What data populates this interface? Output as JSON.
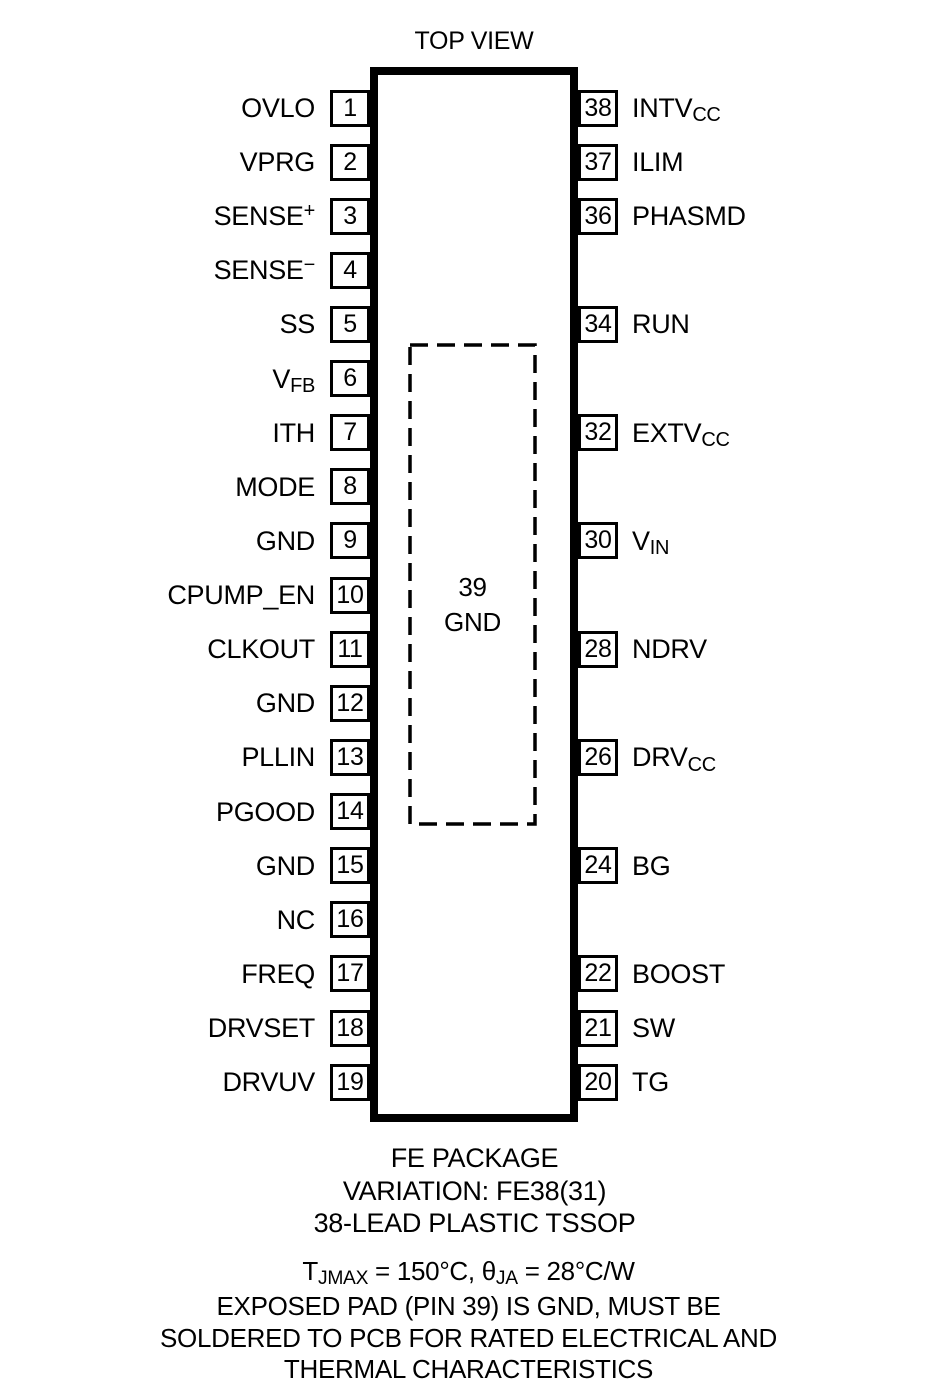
{
  "title": "TOP VIEW",
  "exposed_pad": {
    "number": "39",
    "label": "GND"
  },
  "left_pins": [
    {
      "num": "1",
      "label": [
        {
          "t": "OVLO"
        }
      ]
    },
    {
      "num": "2",
      "label": [
        {
          "t": "VPRG"
        }
      ]
    },
    {
      "num": "3",
      "label": [
        {
          "t": "SENSE"
        },
        {
          "t": "+",
          "style": "sup"
        }
      ]
    },
    {
      "num": "4",
      "label": [
        {
          "t": "SENSE"
        },
        {
          "t": "−",
          "style": "sup"
        }
      ]
    },
    {
      "num": "5",
      "label": [
        {
          "t": "SS"
        }
      ]
    },
    {
      "num": "6",
      "label": [
        {
          "t": "V"
        },
        {
          "t": "FB",
          "style": "sub"
        }
      ]
    },
    {
      "num": "7",
      "label": [
        {
          "t": "ITH"
        }
      ]
    },
    {
      "num": "8",
      "label": [
        {
          "t": "MODE"
        }
      ]
    },
    {
      "num": "9",
      "label": [
        {
          "t": "GND"
        }
      ]
    },
    {
      "num": "10",
      "label": [
        {
          "t": "CPUMP_EN"
        }
      ]
    },
    {
      "num": "11",
      "label": [
        {
          "t": "CLKOUT"
        }
      ]
    },
    {
      "num": "12",
      "label": [
        {
          "t": "GND"
        }
      ]
    },
    {
      "num": "13",
      "label": [
        {
          "t": "PLLIN"
        }
      ]
    },
    {
      "num": "14",
      "label": [
        {
          "t": "PGOOD"
        }
      ]
    },
    {
      "num": "15",
      "label": [
        {
          "t": "GND"
        }
      ]
    },
    {
      "num": "16",
      "label": [
        {
          "t": "NC"
        }
      ]
    },
    {
      "num": "17",
      "label": [
        {
          "t": "FREQ"
        }
      ]
    },
    {
      "num": "18",
      "label": [
        {
          "t": "DRVSET"
        }
      ]
    },
    {
      "num": "19",
      "label": [
        {
          "t": "DRVUV"
        }
      ]
    }
  ],
  "right_pins": [
    {
      "num": "38",
      "row": 1,
      "label": [
        {
          "t": "INTV"
        },
        {
          "t": "CC",
          "style": "sub"
        }
      ]
    },
    {
      "num": "37",
      "row": 2,
      "label": [
        {
          "t": "ILIM"
        }
      ]
    },
    {
      "num": "36",
      "row": 3,
      "label": [
        {
          "t": "PHASMD"
        }
      ]
    },
    {
      "num": "34",
      "row": 5,
      "label": [
        {
          "t": "RUN"
        }
      ]
    },
    {
      "num": "32",
      "row": 7,
      "label": [
        {
          "t": "EXTV"
        },
        {
          "t": "CC",
          "style": "sub"
        }
      ]
    },
    {
      "num": "30",
      "row": 9,
      "label": [
        {
          "t": "V"
        },
        {
          "t": "IN",
          "style": "sub"
        }
      ]
    },
    {
      "num": "28",
      "row": 11,
      "label": [
        {
          "t": "NDRV"
        }
      ]
    },
    {
      "num": "26",
      "row": 13,
      "label": [
        {
          "t": "DRV"
        },
        {
          "t": "CC",
          "style": "sub"
        }
      ]
    },
    {
      "num": "24",
      "row": 15,
      "label": [
        {
          "t": "BG"
        }
      ]
    },
    {
      "num": "22",
      "row": 17,
      "label": [
        {
          "t": "BOOST"
        }
      ]
    },
    {
      "num": "21",
      "row": 18,
      "label": [
        {
          "t": "SW"
        }
      ]
    },
    {
      "num": "20",
      "row": 19,
      "label": [
        {
          "t": "TG"
        }
      ]
    }
  ],
  "package": {
    "caption_lines": [
      "FE PACKAGE",
      "VARIATION: FE38(31)",
      "38-LEAD PLASTIC TSSOP"
    ]
  },
  "note_lines": [
    [
      {
        "t": "T"
      },
      {
        "t": "JMAX",
        "style": "sub"
      },
      {
        "t": " = 150°C, "
      },
      {
        "t": "θ"
      },
      {
        "t": "JA",
        "style": "sub"
      },
      {
        "t": " = 28°C/W"
      }
    ],
    [
      {
        "t": "EXPOSED PAD (PIN 39) IS GND, MUST BE"
      }
    ],
    [
      {
        "t": "SOLDERED TO PCB FOR RATED ELECTRICAL AND"
      }
    ],
    [
      {
        "t": "THERMAL CHARACTERISTICS"
      }
    ]
  ],
  "colors": {
    "ink": "#000000",
    "background": "#ffffff"
  }
}
